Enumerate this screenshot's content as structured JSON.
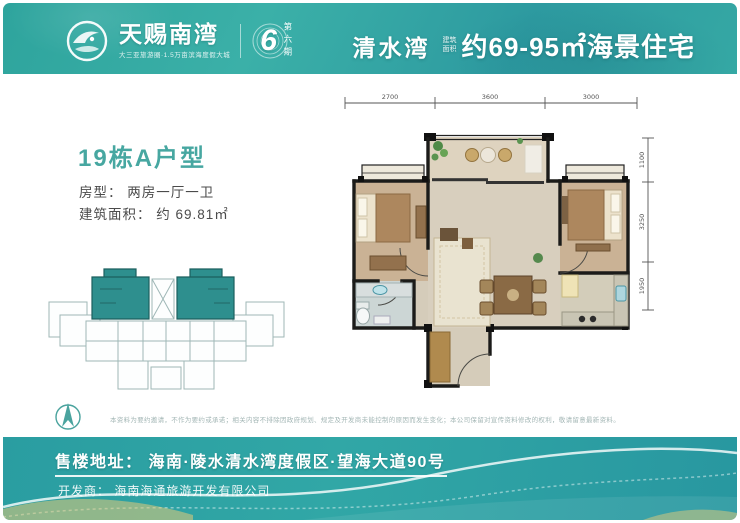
{
  "header": {
    "brand": "天赐南湾",
    "brand_tagline": "大三亚旅游圈·1.5万亩滨海度假大城",
    "phase_number": "6",
    "phase_label": "第六期",
    "project": "清水湾",
    "area_tag_line1": "建筑",
    "area_tag_line2": "面积",
    "headline": "约69-95㎡海景住宅"
  },
  "unit": {
    "title": "19栋A户型",
    "type_label": "房型：",
    "type_value": "两房一厅一卫",
    "area_label": "建筑面积：",
    "area_value": "约 69.81㎡"
  },
  "floor_plan": {
    "dims_top": [
      "2700",
      "3600",
      "3000"
    ],
    "dims_right": [
      "1100",
      "3250",
      "1950"
    ],
    "rooms": [
      "balcony",
      "bedroom",
      "bathroom",
      "living-dining-room",
      "master-bedroom",
      "kitchen",
      "entry"
    ]
  },
  "disclaimer": "本资料为要约邀请，不作为要约或承诺；相关内容不排除因政府规划、规定及开发商未能控制的原因而发生变化；本公司保留对宣传资料修改的权利，敬请留意最新资料。",
  "footer": {
    "address_label": "售楼地址：",
    "address": "海南·陵水清水湾度假区·望海大道90号",
    "developer_label": "开发商：",
    "developer": "海南海通旅游开发有限公司"
  },
  "colors": {
    "teal_header": "#2fa3a0",
    "teal_accent": "#47a7a1",
    "keyplan_highlight": "#2e8f8e"
  }
}
